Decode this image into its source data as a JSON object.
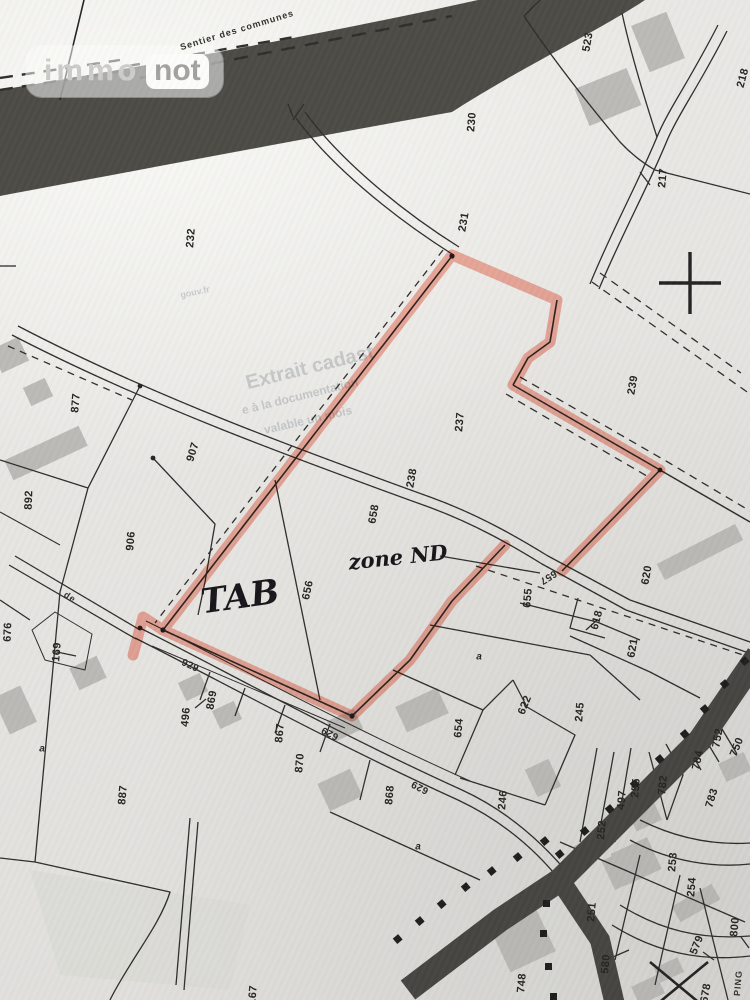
{
  "logo": {
    "immo": "immo",
    "not": "not"
  },
  "colors": {
    "paper": "#e7e6e3",
    "line": "#2e2d2b",
    "dark_band": "#45443f",
    "building": "#b3b2ae",
    "highlighter": "#f4836e",
    "handwriting": "#15151a"
  },
  "annotations": [
    {
      "t": "TAB",
      "x": 240,
      "y": 597,
      "r": -8,
      "s": 34,
      "k": "hand"
    },
    {
      "t": "zone ND",
      "x": 398,
      "y": 557,
      "r": -6,
      "s": 21,
      "k": "hand"
    }
  ],
  "watermark": [
    {
      "t": "Extrait cadast",
      "x": 310,
      "y": 368,
      "r": -14,
      "s": 20,
      "k": "watermark"
    },
    {
      "t": "e à la documentation",
      "x": 300,
      "y": 396,
      "r": -14,
      "s": 12,
      "k": "watermark"
    },
    {
      "t": "valable un mois",
      "x": 308,
      "y": 420,
      "r": -13,
      "s": 12,
      "k": "watermark"
    },
    {
      "t": "gouv.fr",
      "x": 195,
      "y": 292,
      "r": -12,
      "s": 9,
      "k": "watermark"
    }
  ],
  "street_labels": [
    {
      "t": "Sentier des communes",
      "x": 237,
      "y": 30,
      "r": -17,
      "k": "street"
    },
    {
      "t": "de",
      "x": 70,
      "y": 597,
      "r": 33,
      "k": "street"
    },
    {
      "t": "PING",
      "x": 738,
      "y": 983,
      "r": -85,
      "k": "street"
    }
  ],
  "road_labels": [
    {
      "t": "657",
      "x": 548,
      "y": 577,
      "r": 148,
      "k": "road"
    },
    {
      "t": "629",
      "x": 330,
      "y": 733,
      "r": 207,
      "k": "road"
    },
    {
      "t": "629",
      "x": 420,
      "y": 787,
      "r": 207,
      "k": "road"
    },
    {
      "t": "929",
      "x": 190,
      "y": 666,
      "r": 25,
      "k": "road"
    }
  ],
  "letter_labels": [
    {
      "t": "a",
      "x": 479,
      "y": 657,
      "r": 0,
      "k": "letter"
    },
    {
      "t": "a",
      "x": 42,
      "y": 749,
      "r": 0,
      "k": "letter"
    },
    {
      "t": "a",
      "x": 418,
      "y": 847,
      "r": 0,
      "k": "letter"
    }
  ],
  "parcel_labels": [
    {
      "t": "523",
      "x": 588,
      "y": 42,
      "r": -80
    },
    {
      "t": "218",
      "x": 743,
      "y": 78,
      "r": -75
    },
    {
      "t": "230",
      "x": 472,
      "y": 122,
      "r": -85
    },
    {
      "t": "217",
      "x": 663,
      "y": 178,
      "r": -85
    },
    {
      "t": "232",
      "x": 191,
      "y": 238,
      "r": -85
    },
    {
      "t": "231",
      "x": 464,
      "y": 222,
      "r": -80
    },
    {
      "t": "239",
      "x": 633,
      "y": 385,
      "r": -80
    },
    {
      "t": "237",
      "x": 460,
      "y": 422,
      "r": -85
    },
    {
      "t": "238",
      "x": 412,
      "y": 478,
      "r": -80
    },
    {
      "t": "658",
      "x": 374,
      "y": 514,
      "r": -80
    },
    {
      "t": "877",
      "x": 76,
      "y": 403,
      "r": -85
    },
    {
      "t": "907",
      "x": 193,
      "y": 452,
      "r": -73
    },
    {
      "t": "892",
      "x": 29,
      "y": 500,
      "r": -88
    },
    {
      "t": "906",
      "x": 131,
      "y": 541,
      "r": -85
    },
    {
      "t": "656",
      "x": 308,
      "y": 590,
      "r": -78
    },
    {
      "t": "655",
      "x": 528,
      "y": 598,
      "r": -85
    },
    {
      "t": "620",
      "x": 647,
      "y": 575,
      "r": -80
    },
    {
      "t": "618",
      "x": 597,
      "y": 620,
      "r": -75
    },
    {
      "t": "621",
      "x": 633,
      "y": 648,
      "r": -80
    },
    {
      "t": "676",
      "x": 8,
      "y": 632,
      "r": -88
    },
    {
      "t": "169",
      "x": 57,
      "y": 652,
      "r": -85
    },
    {
      "t": "869",
      "x": 212,
      "y": 700,
      "r": -80
    },
    {
      "t": "496",
      "x": 186,
      "y": 717,
      "r": -85
    },
    {
      "t": "867",
      "x": 280,
      "y": 733,
      "r": -85
    },
    {
      "t": "870",
      "x": 300,
      "y": 763,
      "r": -85
    },
    {
      "t": "887",
      "x": 123,
      "y": 795,
      "r": -85
    },
    {
      "t": "868",
      "x": 390,
      "y": 795,
      "r": -85
    },
    {
      "t": "654",
      "x": 459,
      "y": 728,
      "r": -85
    },
    {
      "t": "622",
      "x": 525,
      "y": 705,
      "r": -68
    },
    {
      "t": "246",
      "x": 503,
      "y": 800,
      "r": -85
    },
    {
      "t": "245",
      "x": 580,
      "y": 712,
      "r": -85
    },
    {
      "t": "752",
      "x": 718,
      "y": 738,
      "r": -80
    },
    {
      "t": "750",
      "x": 737,
      "y": 747,
      "r": -68
    },
    {
      "t": "784",
      "x": 698,
      "y": 760,
      "r": -78
    },
    {
      "t": "782",
      "x": 663,
      "y": 785,
      "r": -85
    },
    {
      "t": "255",
      "x": 636,
      "y": 788,
      "r": -85
    },
    {
      "t": "497",
      "x": 622,
      "y": 800,
      "r": -85
    },
    {
      "t": "783",
      "x": 712,
      "y": 798,
      "r": -73
    },
    {
      "t": "252",
      "x": 602,
      "y": 830,
      "r": -85
    },
    {
      "t": "253",
      "x": 673,
      "y": 862,
      "r": -85
    },
    {
      "t": "254",
      "x": 692,
      "y": 887,
      "r": -85
    },
    {
      "t": "251",
      "x": 592,
      "y": 912,
      "r": -85
    },
    {
      "t": "800",
      "x": 735,
      "y": 927,
      "r": -85
    },
    {
      "t": "579",
      "x": 697,
      "y": 945,
      "r": -68
    },
    {
      "t": "580",
      "x": 606,
      "y": 964,
      "r": -85
    },
    {
      "t": "748",
      "x": 522,
      "y": 983,
      "r": -85
    },
    {
      "t": "167",
      "x": 253,
      "y": 995,
      "r": -85
    },
    {
      "t": "678",
      "x": 706,
      "y": 993,
      "r": -80
    }
  ]
}
